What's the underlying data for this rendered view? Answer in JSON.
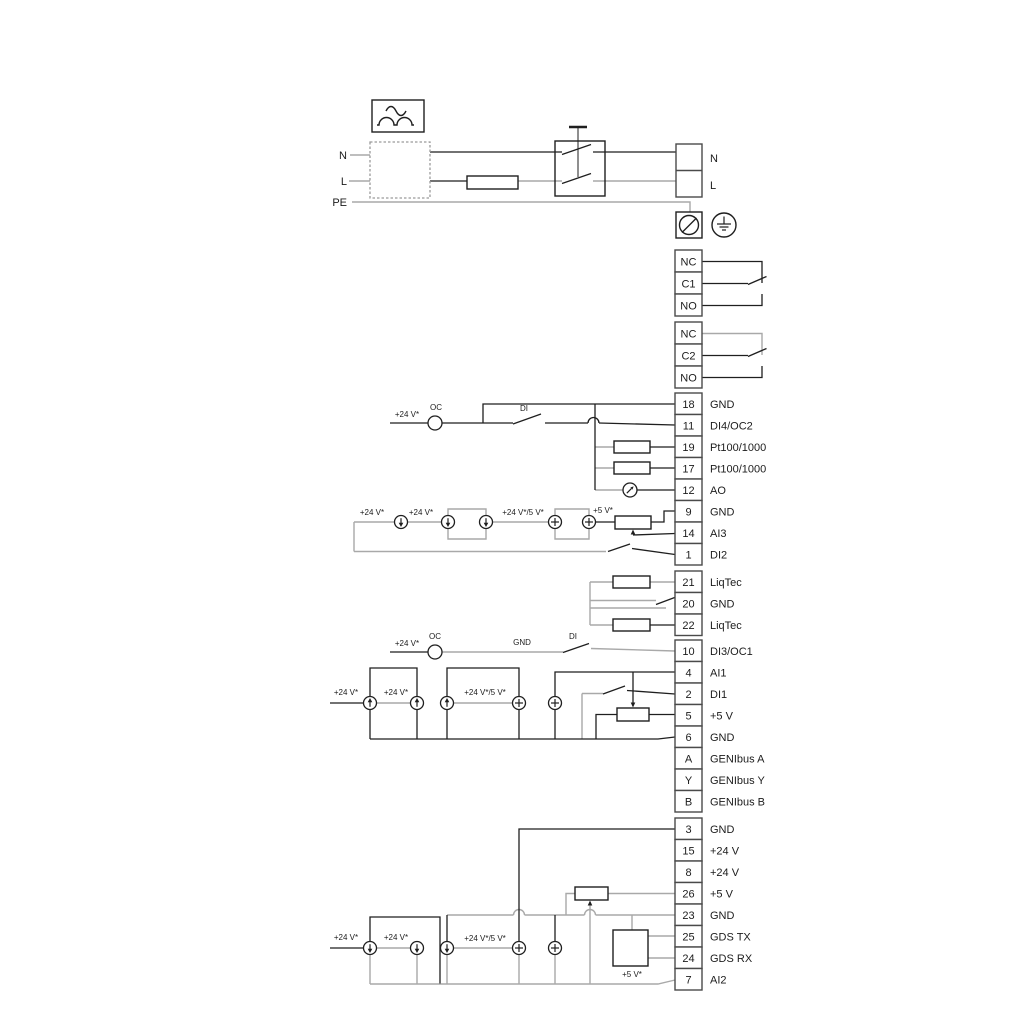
{
  "diagram": {
    "type": "pump-controller-wiring-diagram",
    "colors": {
      "background": "#ffffff",
      "wire_dark": "#1f1f1f",
      "wire_gray": "#a9a9a9",
      "terminal_border": "#4a4a4a"
    }
  },
  "mains": {
    "in_n": "N",
    "in_l": "L",
    "in_pe": "PE",
    "out_n": "N",
    "out_l": "L"
  },
  "relay1": {
    "r0": "NC",
    "r1": "C1",
    "r2": "NO"
  },
  "relay2": {
    "r0": "NC",
    "r1": "C2",
    "r2": "NO"
  },
  "block_io1": {
    "rows": [
      {
        "num": "18",
        "label": "GND"
      },
      {
        "num": "11",
        "label": "DI4/OC2"
      },
      {
        "num": "19",
        "label": "Pt100/1000"
      },
      {
        "num": "17",
        "label": "Pt100/1000"
      },
      {
        "num": "12",
        "label": "AO"
      },
      {
        "num": "9",
        "label": "GND"
      },
      {
        "num": "14",
        "label": "AI3"
      },
      {
        "num": "1",
        "label": "DI2"
      }
    ]
  },
  "block_liqtec": {
    "rows": [
      {
        "num": "21",
        "label": "LiqTec"
      },
      {
        "num": "20",
        "label": "GND"
      },
      {
        "num": "22",
        "label": "LiqTec"
      }
    ]
  },
  "block_io2": {
    "rows": [
      {
        "num": "10",
        "label": "DI3/OC1"
      },
      {
        "num": "4",
        "label": "AI1"
      },
      {
        "num": "2",
        "label": "DI1"
      },
      {
        "num": "5",
        "label": "+5 V"
      },
      {
        "num": "6",
        "label": "GND"
      },
      {
        "num": "A",
        "label": "GENIbus A"
      },
      {
        "num": "Y",
        "label": "GENIbus Y"
      },
      {
        "num": "B",
        "label": "GENIbus B"
      }
    ]
  },
  "block_io3": {
    "rows": [
      {
        "num": "3",
        "label": "GND"
      },
      {
        "num": "15",
        "label": "+24 V"
      },
      {
        "num": "8",
        "label": "+24 V"
      },
      {
        "num": "26",
        "label": "+5 V"
      },
      {
        "num": "23",
        "label": "GND"
      },
      {
        "num": "25",
        "label": "GDS TX"
      },
      {
        "num": "24",
        "label": "GDS RX"
      },
      {
        "num": "7",
        "label": "AI2"
      }
    ]
  },
  "oc1": {
    "supply": "+24 V*",
    "oc": "OC",
    "di": "DI"
  },
  "analog1": {
    "s1": "+24 V*",
    "s2": "+24 V*",
    "s3": "+24 V*/5 V*",
    "s4": "+5 V*"
  },
  "oc2": {
    "supply": "+24 V*",
    "oc": "OC",
    "gnd": "GND",
    "di": "DI"
  },
  "analog2": {
    "s1": "+24 V*",
    "s2": "+24 V*",
    "s3": "+24 V*/5 V*"
  },
  "analog3": {
    "s1": "+24 V*",
    "s2": "+24 V*",
    "s3": "+24 V*/5 V*",
    "s4": "+5 V*"
  }
}
